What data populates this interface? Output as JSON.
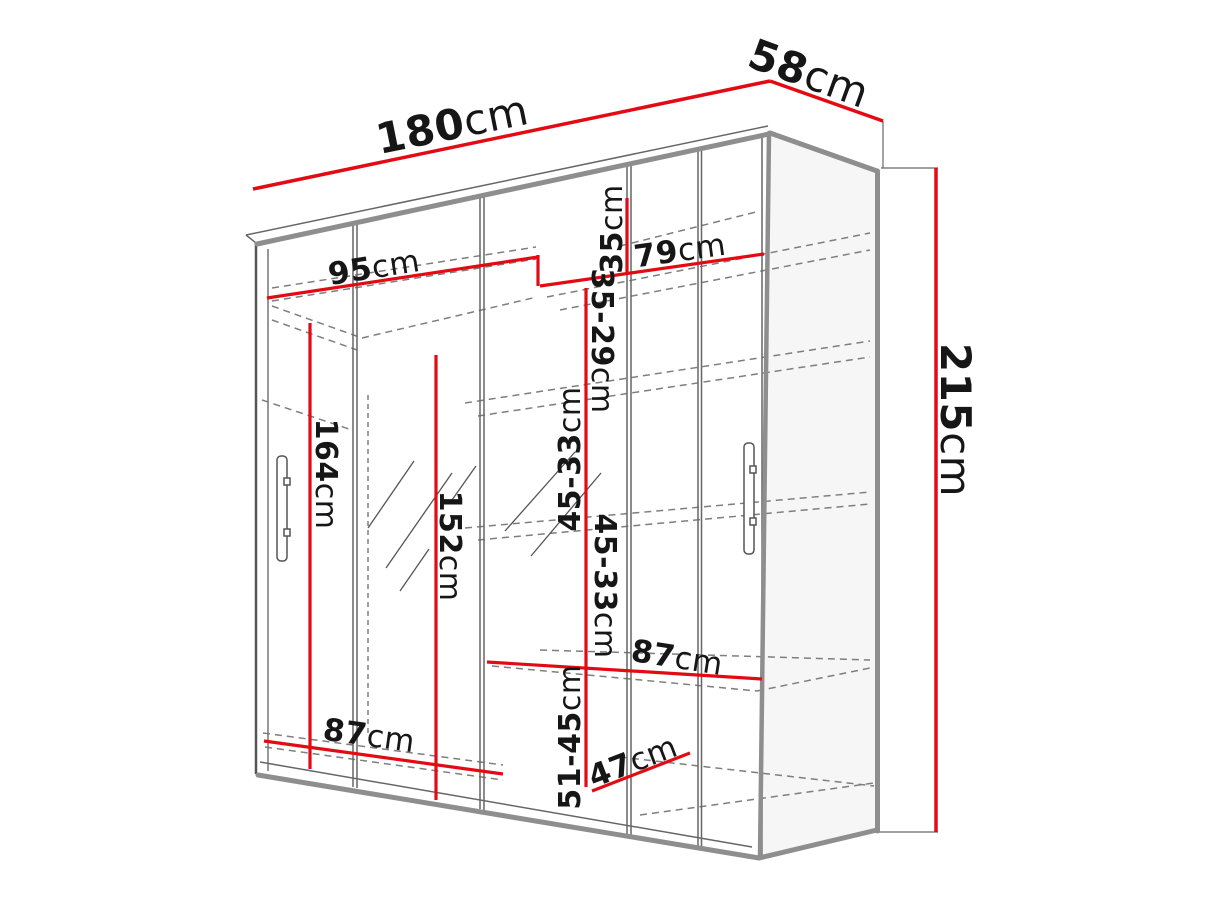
{
  "title": "Wardrobe dimension diagram",
  "colors": {
    "dimension_red": "#e30b13",
    "outline_gray": "#8e8e8e",
    "line_dark": "#555555",
    "dashed_gray": "#7e7e7e",
    "text": "#161616",
    "background": "#ffffff"
  },
  "dimensions": {
    "width": {
      "value": "180",
      "unit": "cm"
    },
    "depth": {
      "value": "58",
      "unit": "cm"
    },
    "height": {
      "value": "215",
      "unit": "cm"
    },
    "left_inner_width": {
      "value": "95",
      "unit": "cm"
    },
    "shelf_width_top": {
      "value": "79",
      "unit": "cm"
    },
    "top_gap": {
      "value": "35",
      "unit": "cm"
    },
    "gap_2": {
      "value": "35-29",
      "unit": "cm"
    },
    "gap_3": {
      "value": "45-33",
      "unit": "cm"
    },
    "gap_4": {
      "value": "45-33",
      "unit": "cm"
    },
    "gap_5": {
      "value": "51-45",
      "unit": "cm"
    },
    "left_height": {
      "value": "164",
      "unit": "cm"
    },
    "mirror_height": {
      "value": "152",
      "unit": "cm"
    },
    "shelf_width_mid": {
      "value": "87",
      "unit": "cm"
    },
    "left_bottom_width": {
      "value": "87",
      "unit": "cm"
    },
    "bottom_depth": {
      "value": "47",
      "unit": "cm"
    }
  }
}
